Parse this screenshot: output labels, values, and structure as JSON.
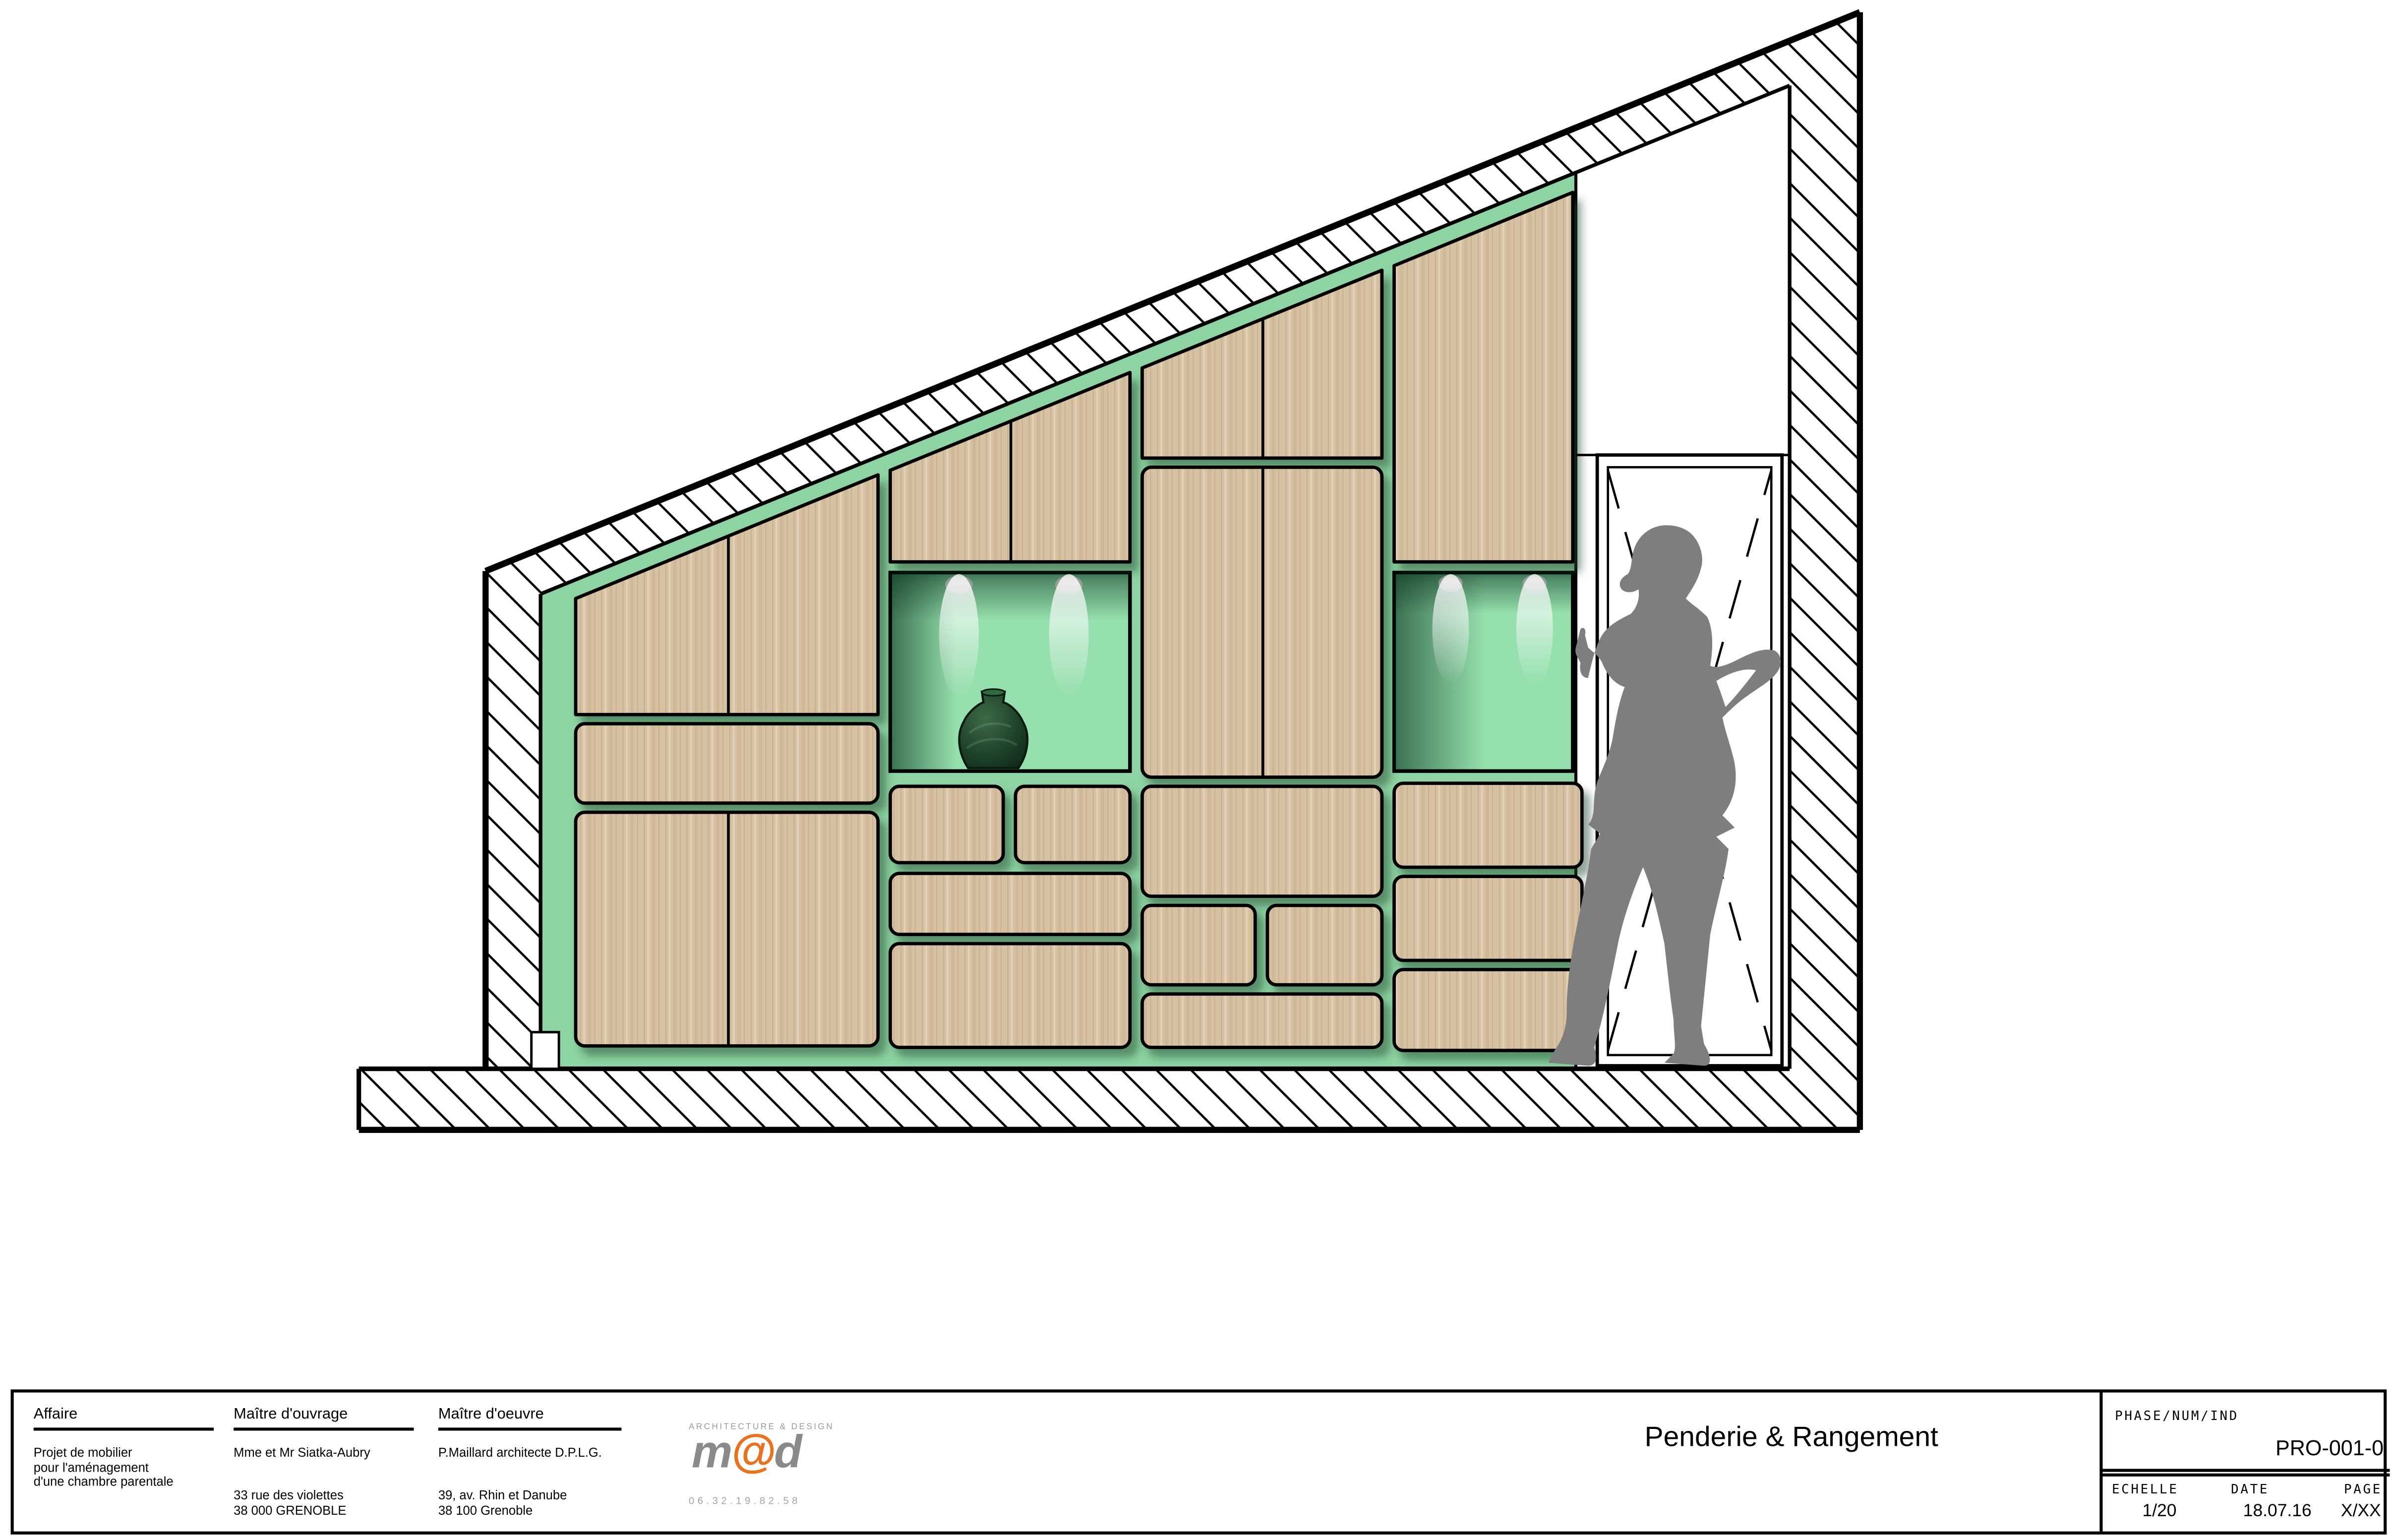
{
  "title_block": {
    "affaire": {
      "label": "Affaire",
      "line1": "Projet de mobilier",
      "line2": "pour l'aménagement",
      "line3": "d'une chambre parentale"
    },
    "maitre_ouvrage": {
      "label": "Maître d'ouvrage",
      "name": "Mme et Mr Siatka-Aubry",
      "address1": "33 rue des violettes",
      "address2": "38 000 GRENOBLE"
    },
    "maitre_oeuvre": {
      "label": "Maître d'oeuvre",
      "name": "P.Maillard architecte D.P.L.G.",
      "address1": "39, av. Rhin et Danube",
      "address2": "38 100 Grenoble"
    },
    "logo": {
      "tagline": "ARCHITECTURE & DESIGN",
      "m": "m",
      "at": "@",
      "d": "d",
      "phone": "06.32.19.82.58"
    },
    "drawing_title": "Penderie & Rangement",
    "phase_label": "PHASE/NUM/IND",
    "phase_value": "PRO-001-0",
    "echelle_label": "ECHELLE",
    "echelle_value": "1/20",
    "date_label": "DATE",
    "date_value": "18.07.16",
    "page_label": "PAGE",
    "page_value": "X/XX"
  },
  "drawing": {
    "subject": "Front elevation of built-in wardrobe and storage under a sloped ceiling, with display niches, spot lights, decorative vase, door opening and human figure for scale",
    "colors": {
      "back_wall_green": "#8ed3a3",
      "niche_green": "#96dfae",
      "wood": "#d6c1a2",
      "outline": "#000000",
      "silhouette_gray": "#7e7e7e",
      "logo_orange": "#e8721f"
    }
  }
}
